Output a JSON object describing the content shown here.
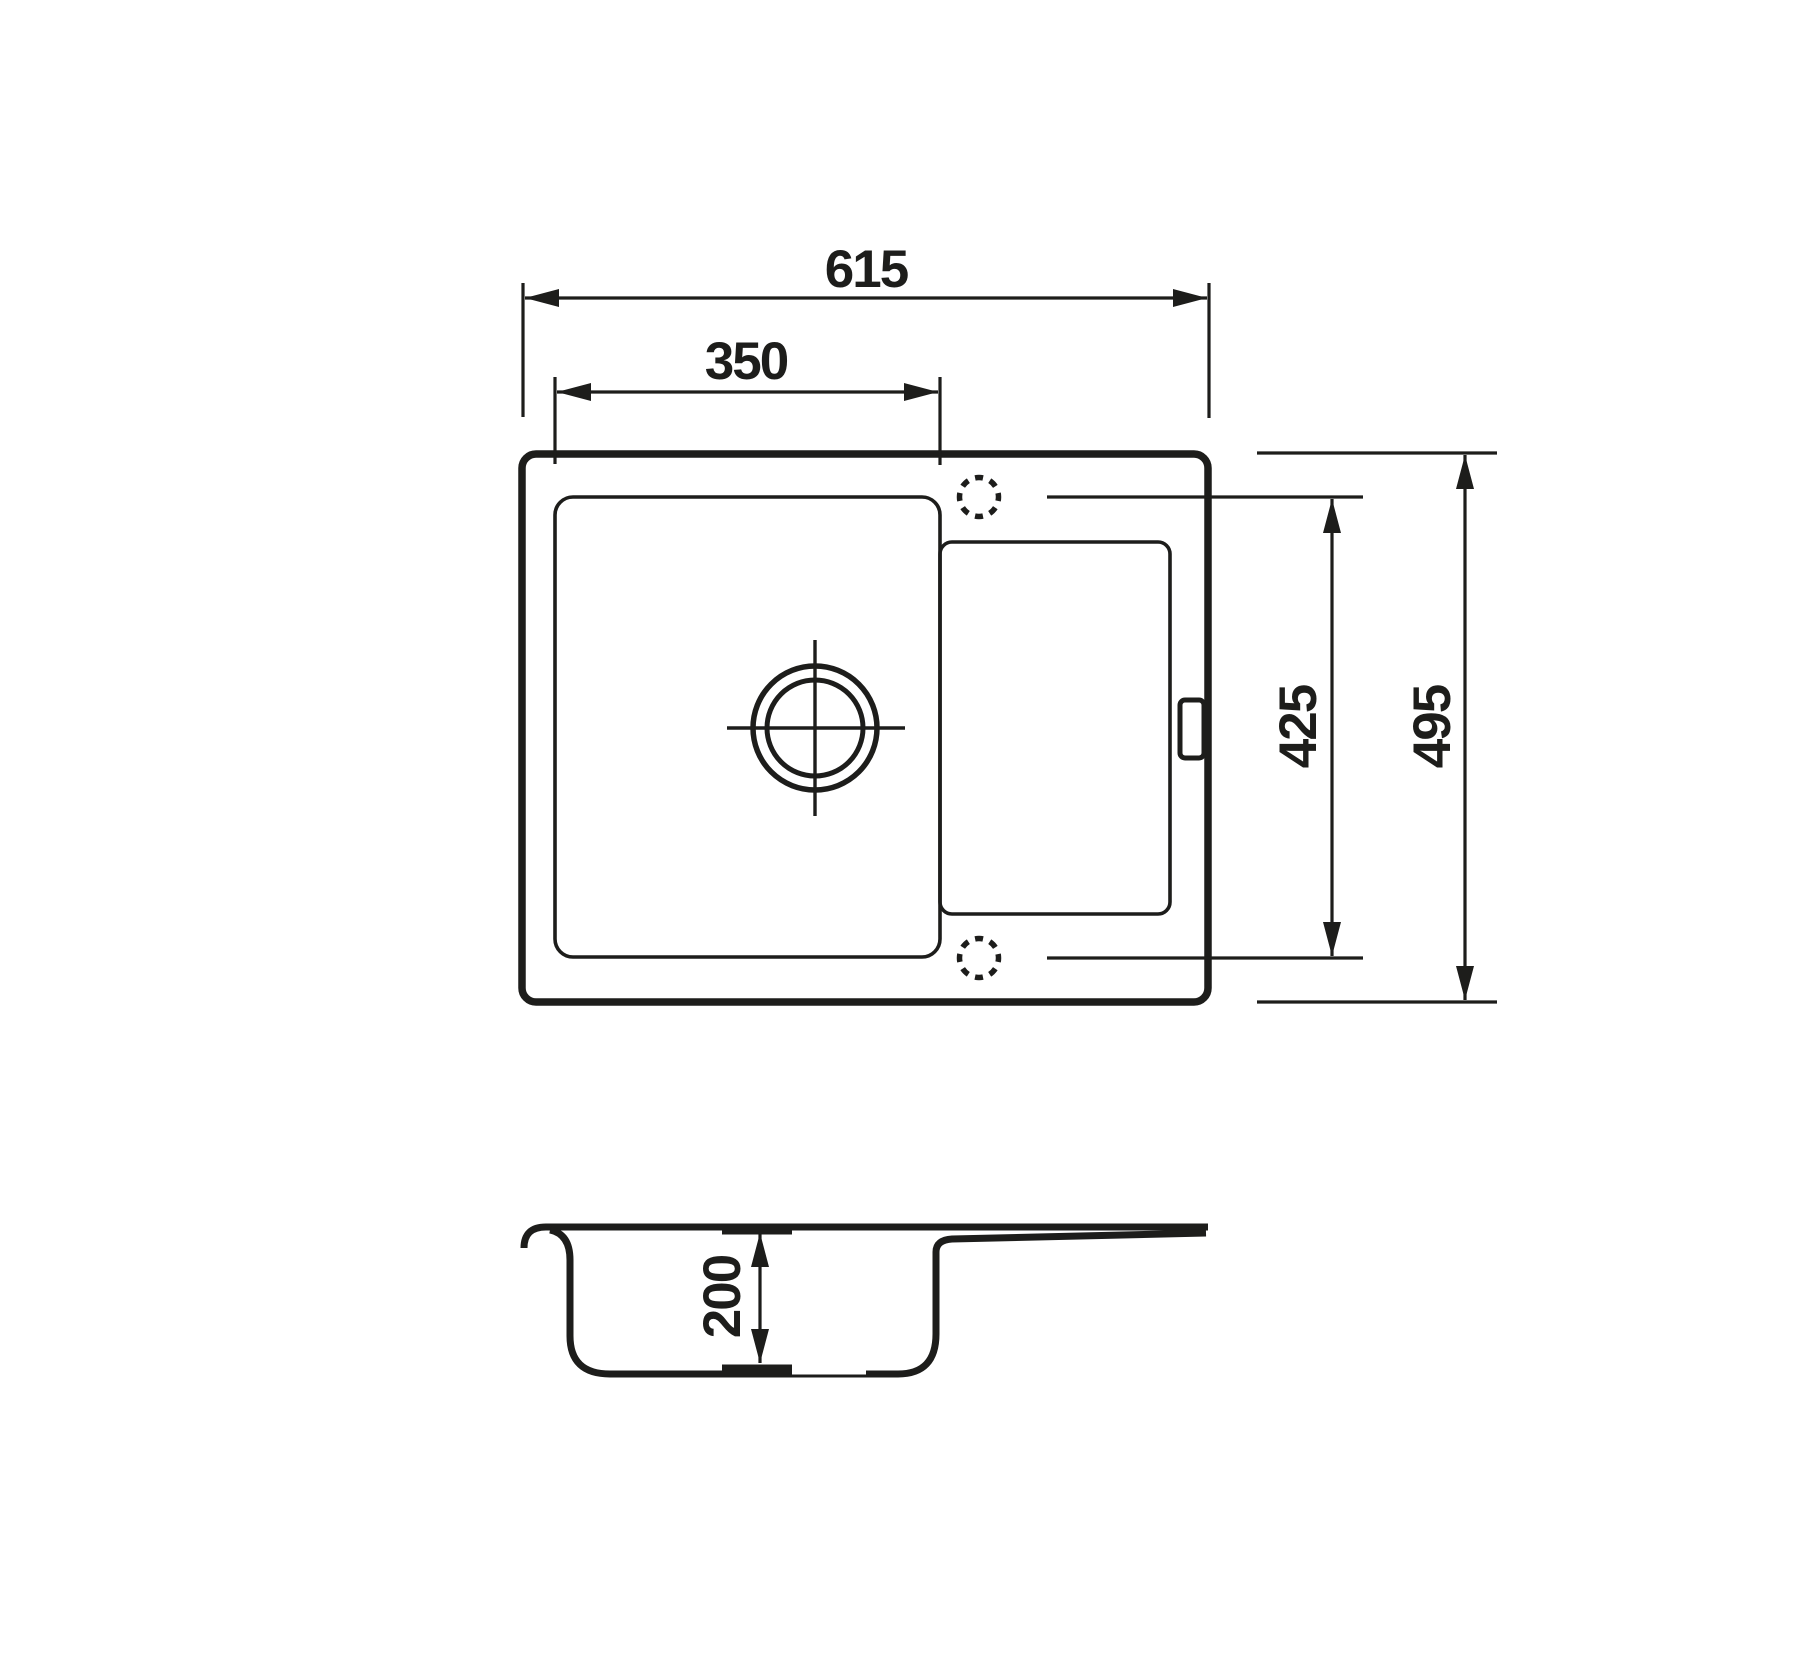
{
  "drawing": {
    "type": "technical-dimension-drawing",
    "subject": "single-bowl kitchen sink with drainboard, top view and section view",
    "line_color": "#1d1d1b",
    "background_color": "#ffffff",
    "dimensions": {
      "overall_width": "615",
      "bowl_width": "350",
      "hole_spacing": "425",
      "overall_depth": "495",
      "bowl_depth": "200"
    }
  }
}
